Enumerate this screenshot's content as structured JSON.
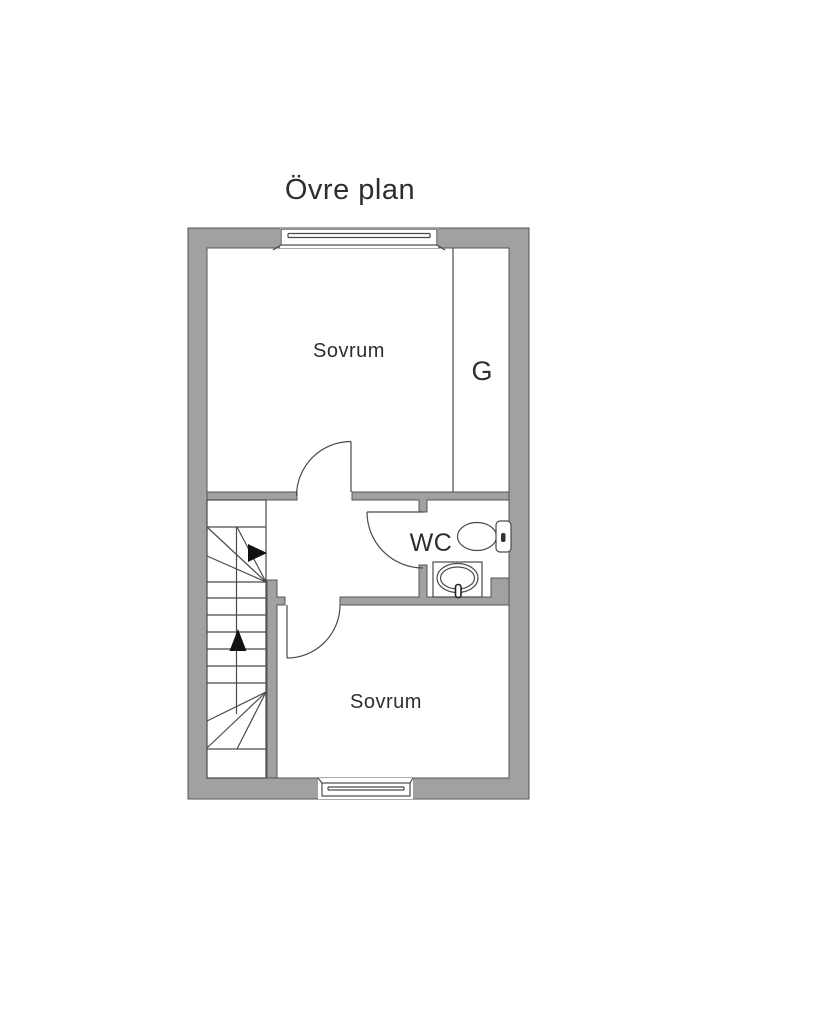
{
  "title": "Övre plan",
  "plan": {
    "floor_name": "Övre plan",
    "rooms": [
      {
        "id": "sovrum-upper",
        "label": "Sovrum"
      },
      {
        "id": "garderob",
        "label": "G"
      },
      {
        "id": "wc",
        "label": "WC"
      },
      {
        "id": "sovrum-lower",
        "label": "Sovrum"
      }
    ],
    "fixtures": [
      "toilet-icon",
      "sink-icon",
      "staircase-icon",
      "window-icon",
      "door-swing-icon"
    ],
    "stair_arrows": [
      "stair-arrow-right-icon",
      "stair-arrow-up-icon"
    ]
  },
  "colors": {
    "wall": "#a1a1a1",
    "wall_outline": "#555555",
    "line": "#4a4a4a",
    "text": "#2e2e2e",
    "arrow": "#111111",
    "background": "#ffffff"
  }
}
